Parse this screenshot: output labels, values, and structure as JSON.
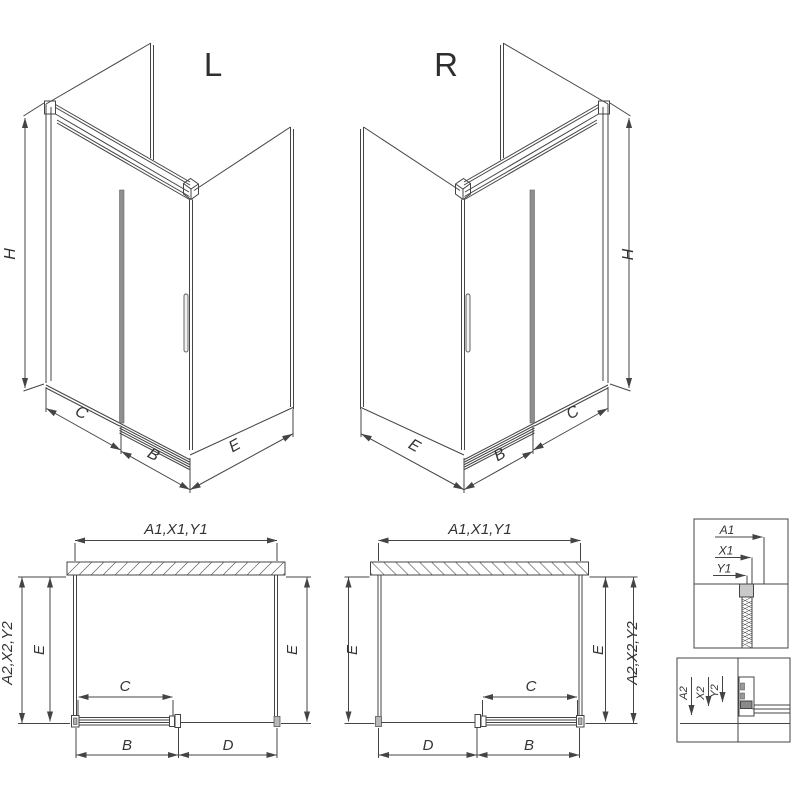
{
  "iso_left": {
    "title": "L",
    "height_label": "H",
    "fixed_panel_label": "C",
    "door_label": "B",
    "side_panel_label": "E"
  },
  "iso_right": {
    "title": "R",
    "height_label": "H",
    "fixed_panel_label": "C",
    "door_label": "B",
    "side_panel_label": "E"
  },
  "plan_left": {
    "width_label": "A1,X1,Y1",
    "outer_depth_label": "A2,X2,Y2",
    "side_left_label": "E",
    "side_right_label": "E",
    "door_clear_label": "C",
    "door_label": "B",
    "fixed_label": "D"
  },
  "plan_right": {
    "width_label": "A1,X1,Y1",
    "outer_depth_label": "A2,X2,Y2",
    "side_left_label": "E",
    "side_right_label": "E",
    "door_clear_label": "C",
    "door_label": "B",
    "fixed_label": "D"
  },
  "detail_wall_profile": {
    "a1": "A1",
    "x1": "X1",
    "y1": "Y1"
  },
  "detail_floor_profile": {
    "a2": "A2",
    "x2": "X2",
    "y2": "Y2"
  },
  "colors": {
    "line": "#444444",
    "door_gray": "#8f8f8f",
    "bracket_gray": "#c9c9c9",
    "track_gray": "#8a8a8a"
  }
}
